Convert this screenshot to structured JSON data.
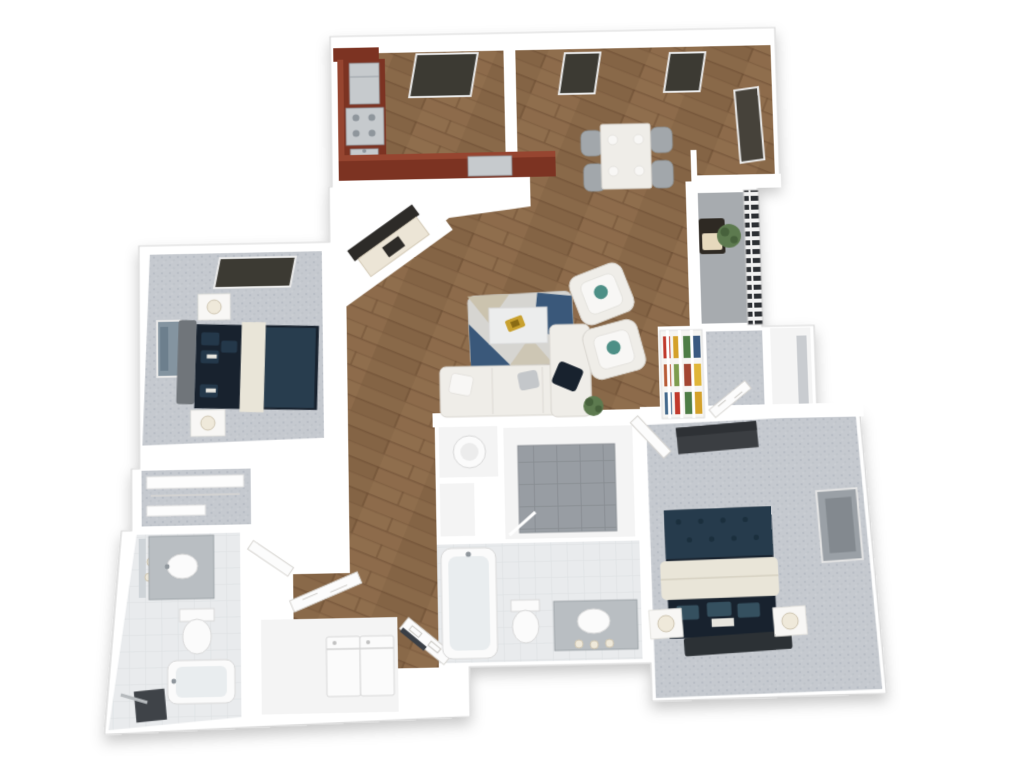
{
  "document": {
    "type": "3d-floor-plan-rendering",
    "description": "Top-down 3D rendered floor plan of a two-bedroom, two-bathroom apartment with balcony",
    "visible_text": ""
  },
  "palette": {
    "wall": "#ffffff",
    "walledge": "#d8d8d8",
    "wood1": "#8d6b4b",
    "wood2": "#7a5a3e",
    "woodline": "#66492f",
    "carpet": "#c5c9cf",
    "carpetdot": "#aab0b8",
    "cherry": "#7c3322",
    "cherrytop": "#964530",
    "steel": "#c6cacd",
    "steeldark": "#8f969c",
    "darkwin": "#3c3a33",
    "navy": "#18222e",
    "teal": "#2b4254",
    "cream": "#e9e5d8",
    "chairgray": "#a2a7ab",
    "furn": "#efede8",
    "furnstroke": "#d9d6d0",
    "tilegray": "#989da3",
    "tileline": "#878c91",
    "bathbase": "#e9ebed",
    "bathline": "#dcdfe2",
    "balconyfloor": "#a7abaf",
    "rail": "#2c2f33",
    "gold": "#c8a02e",
    "plant": "#5d7a4f",
    "headboard": "#70757a",
    "headboarddark": "#2c3135",
    "rugbase": "#d6d5d1",
    "rugnavy": "#3a587a",
    "rugtan": "#c9bfa8",
    "counter": "#b9bec2",
    "bookshelfbg": "#f6f5f2"
  },
  "bookshelf": {
    "colors": [
      "#c0392b",
      "#d4a12a",
      "#4e7d46",
      "#3b5a80",
      "#b85c38",
      "#7d9c4f",
      "#a34632",
      "#e0b63a",
      "#44698c",
      "#c0392b",
      "#4e7d46",
      "#d4a12a"
    ]
  },
  "rooms": [
    {
      "name": "Kitchen",
      "floor": "wood",
      "furniture": [
        "cherry cabinets",
        "refrigerator",
        "range",
        "sink",
        "window"
      ]
    },
    {
      "name": "Dining Area",
      "floor": "wood",
      "furniture": [
        "dining table",
        "4 chairs",
        "2 windows",
        "side door"
      ],
      "chairs": 4
    },
    {
      "name": "Living Room",
      "floor": "wood",
      "furniture": [
        "sectional sofa",
        "2 armchairs",
        "coffee table with gold decor",
        "area rug",
        "media console with TV",
        "floor plant"
      ]
    },
    {
      "name": "Balcony",
      "floor": "concrete",
      "furniture": [
        "railing",
        "bistro seat",
        "potted plant"
      ]
    },
    {
      "name": "Bedroom 2",
      "floor": "carpet",
      "furniture": [
        "bed with navy bedding",
        "2 nightstands",
        "2 lamps",
        "window",
        "wall art"
      ]
    },
    {
      "name": "Bedroom 2 Closet",
      "floor": "carpet",
      "furniture": [
        "shelving"
      ]
    },
    {
      "name": "Bathroom 2",
      "floor": "tile",
      "furniture": [
        "vanity with sink",
        "mirror with sconces",
        "toilet",
        "bathtub",
        "dark floor mat"
      ]
    },
    {
      "name": "Hallway",
      "floor": "wood",
      "furniture": [
        "open doors"
      ]
    },
    {
      "name": "Linen Closet",
      "floor": "tile",
      "furniture": [
        "round laundry basket"
      ]
    },
    {
      "name": "Walk-in Shower Room",
      "floor": "tile",
      "furniture": [
        "tiled shower floor"
      ]
    },
    {
      "name": "Master Bathroom",
      "floor": "tile",
      "furniture": [
        "bathtub",
        "toilet",
        "vanity with sink"
      ]
    },
    {
      "name": "Laundry Closet",
      "floor": "tile",
      "furniture": [
        "washer",
        "dryer",
        "open door"
      ]
    },
    {
      "name": "Master Bedroom",
      "floor": "carpet",
      "furniture": [
        "bed with navy and cream bedding",
        "2 nightstands",
        "2 lamps",
        "tv stand",
        "window",
        "wall niche"
      ]
    },
    {
      "name": "Master Closet",
      "floor": "carpet",
      "furniture": [
        "open door"
      ]
    },
    {
      "name": "Bookshelf Nook",
      "floor": "wood",
      "furniture": [
        "bookshelf with colorful books"
      ]
    }
  ]
}
